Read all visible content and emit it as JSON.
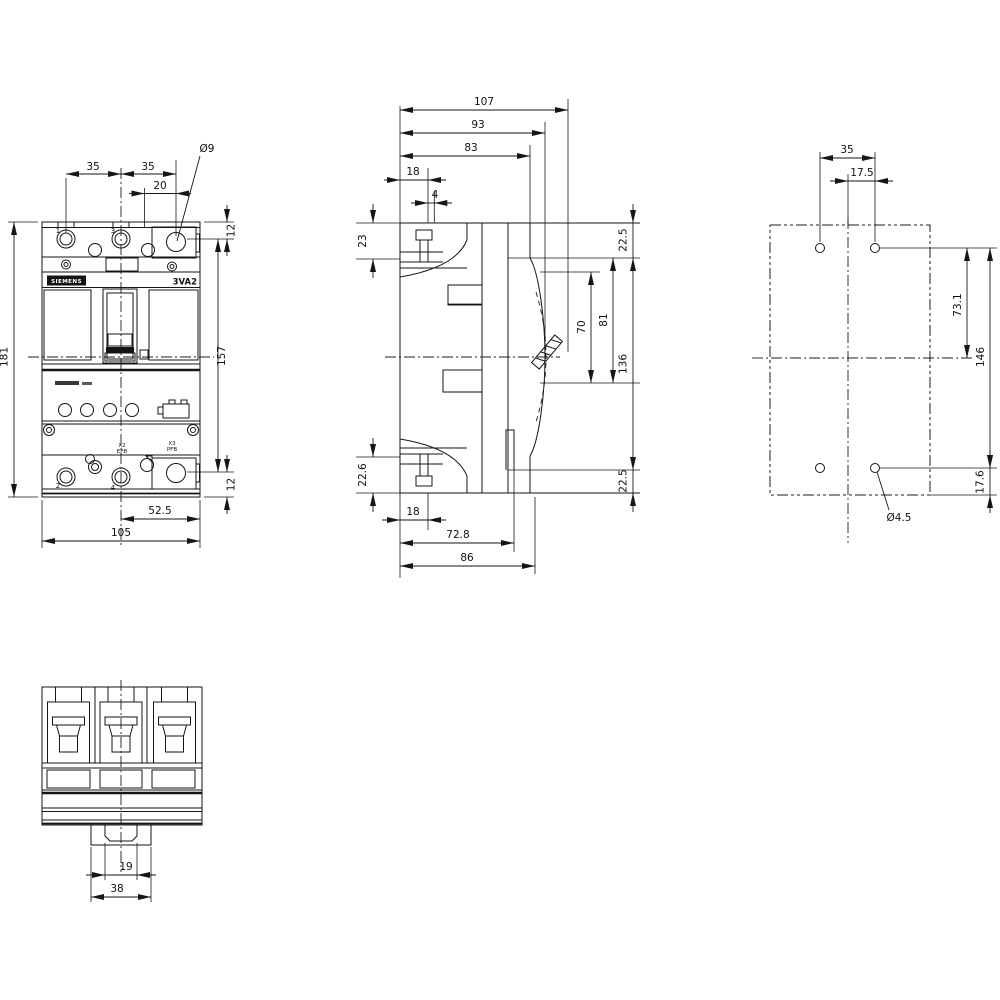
{
  "drawing_title": "3VA2 molded case circuit breaker dimension drawing",
  "brand_label": "SIEMENS",
  "model_label": "3VA2",
  "front": {
    "dim_35_left": "35",
    "dim_35_right": "35",
    "dim_20": "20",
    "hole_dia": "Ø9",
    "dim_12_top": "12",
    "dim_181": "181",
    "dim_157": "157",
    "dim_12_bottom": "12",
    "dim_52_5": "52.5",
    "dim_105": "105",
    "terminal_1": "1",
    "terminal_3": "3",
    "terminal_2": "2",
    "terminal_4": "4",
    "connector_x2": "X2",
    "connector_x2_sub": "EFB",
    "connector_x3": "X3",
    "connector_x3_sub": "PFB"
  },
  "side": {
    "dim_107": "107",
    "dim_93": "93",
    "dim_83": "83",
    "dim_18_top": "18",
    "dim_4": "4",
    "dim_23": "23",
    "dim_22_5_top": "22.5",
    "dim_70": "70",
    "dim_81": "81",
    "dim_136": "136",
    "dim_22_6": "22.6",
    "dim_22_5_bottom": "22.5",
    "dim_18_bottom": "18",
    "dim_72_8": "72.8",
    "dim_86": "86"
  },
  "mounting": {
    "dim_35": "35",
    "dim_17_5": "17.5",
    "dim_73_1": "73.1",
    "dim_146": "146",
    "dim_17_6": "17.6",
    "hole_dia": "Ø4.5"
  },
  "bottom": {
    "dim_19": "19",
    "dim_38": "38"
  }
}
